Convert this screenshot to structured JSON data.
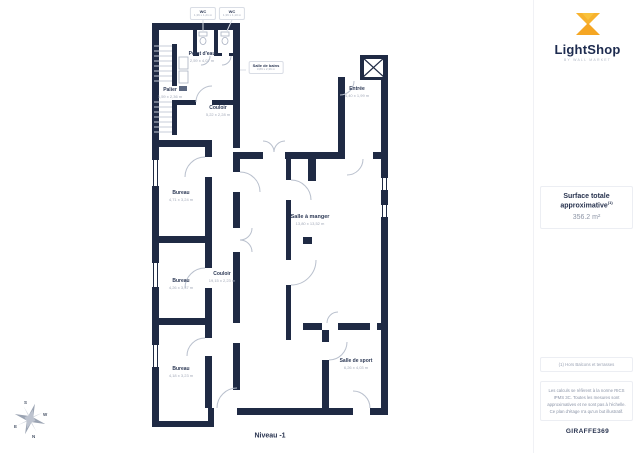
{
  "plan": {
    "level_label": "Niveau -1",
    "rooms": {
      "wc1": {
        "name": "WC",
        "dims": "1,36 x 1,21 m"
      },
      "wc2": {
        "name": "WC",
        "dims": "1,36 x 1,10 m"
      },
      "point_deau": {
        "name": "Point d'eau",
        "dims": "2,59 x 4,07 m"
      },
      "salle_de_bains": {
        "name": "Salle de bains",
        "dims": "3,89 x 2,36 m"
      },
      "palier": {
        "name": "Palier",
        "dims": "1,59 x 2,36 m"
      },
      "couloir_haut": {
        "name": "Couloir",
        "dims": "5,22 x 2,28 m"
      },
      "entree": {
        "name": "Entrée",
        "dims": "4,40 x 1,99 m"
      },
      "bureau_1": {
        "name": "Bureau",
        "dims": "4,71 x 3,24 m"
      },
      "salle_a_manger": {
        "name": "Salle à manger",
        "dims": "13,80 x 13,52 m"
      },
      "bureau_2": {
        "name": "Bureau",
        "dims": "4,26 x 3,37 m"
      },
      "couloir_vertical": {
        "name": "Couloir",
        "dims": "19,15 x 2,23 m"
      },
      "bureau_3": {
        "name": "Bureau",
        "dims": "4,18 x 3,23 m"
      },
      "salle_de_sport": {
        "name": "Salle de sport",
        "dims": "6,26 x 4,03 m"
      }
    },
    "compass": {
      "n": "N",
      "s": "S",
      "e": "E",
      "w": "W"
    }
  },
  "sidebar": {
    "brand": {
      "name": "LightShop",
      "tagline": "BY WALL MARKET"
    },
    "surface": {
      "title": "Surface totale approximative",
      "superscript": "(1)",
      "value": "356.2 m²"
    },
    "footnote": "(1) Hors Balcons et terrasses",
    "disclaimer": "Les calculs se réfèrent à la norme RICS IPMS 3C. Toutes les mesures sont approximatives et ne sont pas à l'échelle. Ce plan d'étage n'a qu'un but illustratif.",
    "reference": "GIRAFFE369"
  },
  "colors": {
    "wall": "#1f2a44",
    "accent_yellow": "#f5a623",
    "accent_yellow_light": "#f9c23c",
    "text_navy": "#27324e",
    "text_gray": "#9aa2b3"
  }
}
